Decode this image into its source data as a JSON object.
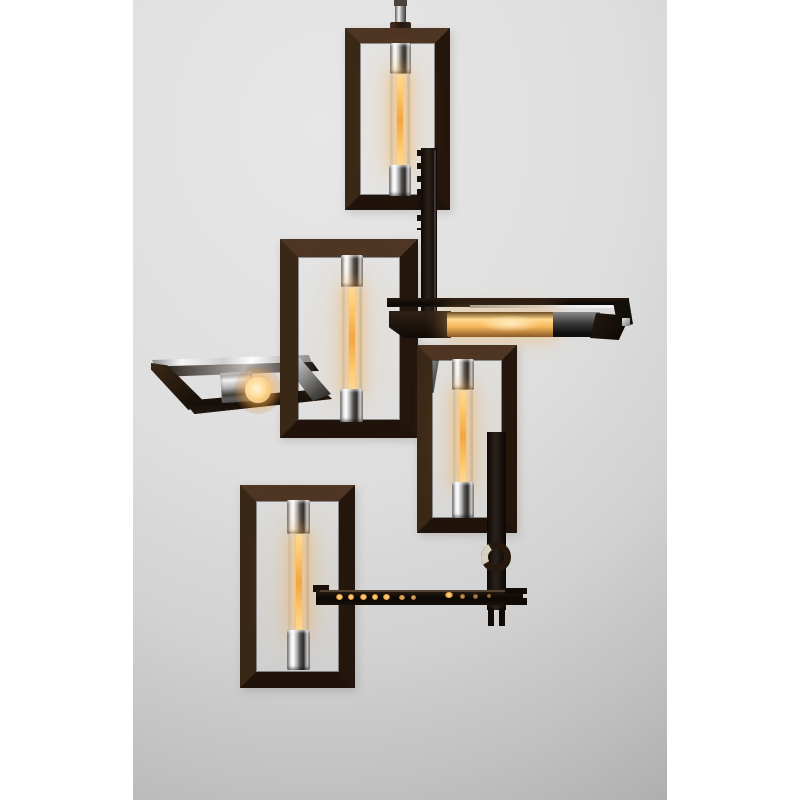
{
  "scene": {
    "type": "product photograph",
    "subject": "Modern geometric chandelier of interlocking rectangular bronze frames with polished nickel sockets and six lit tubular filament bulbs, hung from a central stem against a light gray studio backdrop",
    "backdrop": "light gray studio wall with white side margins",
    "lit_bulb_count": 6
  },
  "colors": {
    "page_margin": "#ffffff",
    "backdrop_light": "#e7e7e7",
    "backdrop_dark": "#a6a6a6",
    "bronze_dark": "#24160d",
    "bronze_light": "#4e3524",
    "edge_black": "#0d0906",
    "chrome_light": "#ffffff",
    "chrome_dark": "#2f2c2a",
    "glow_core": "#ffdf9c",
    "glow_amber": "#f2a642"
  },
  "parts": {
    "stem": "ceiling stem rod",
    "frame_top": "top vertical rectangle frame with tube bulb",
    "frame_mid_left": "large middle-left rectangle frame with tube bulb",
    "frame_horizontal": "horizontal frame seen edge-on with horizontal lit tube bulb",
    "frame_mid_right": "middle-right rectangle frame with tube bulb",
    "frame_tilted_left": "left tilted frame seen edge-on with bulb end facing viewer",
    "frame_bottom_left": "bottom-left rectangle frame with tube bulb",
    "cross_bar_bottom": "lower horizontal bar with amber filament reflections",
    "ring": "round hanger ring detail",
    "side_bar": "vertical edge-on frame bar"
  }
}
